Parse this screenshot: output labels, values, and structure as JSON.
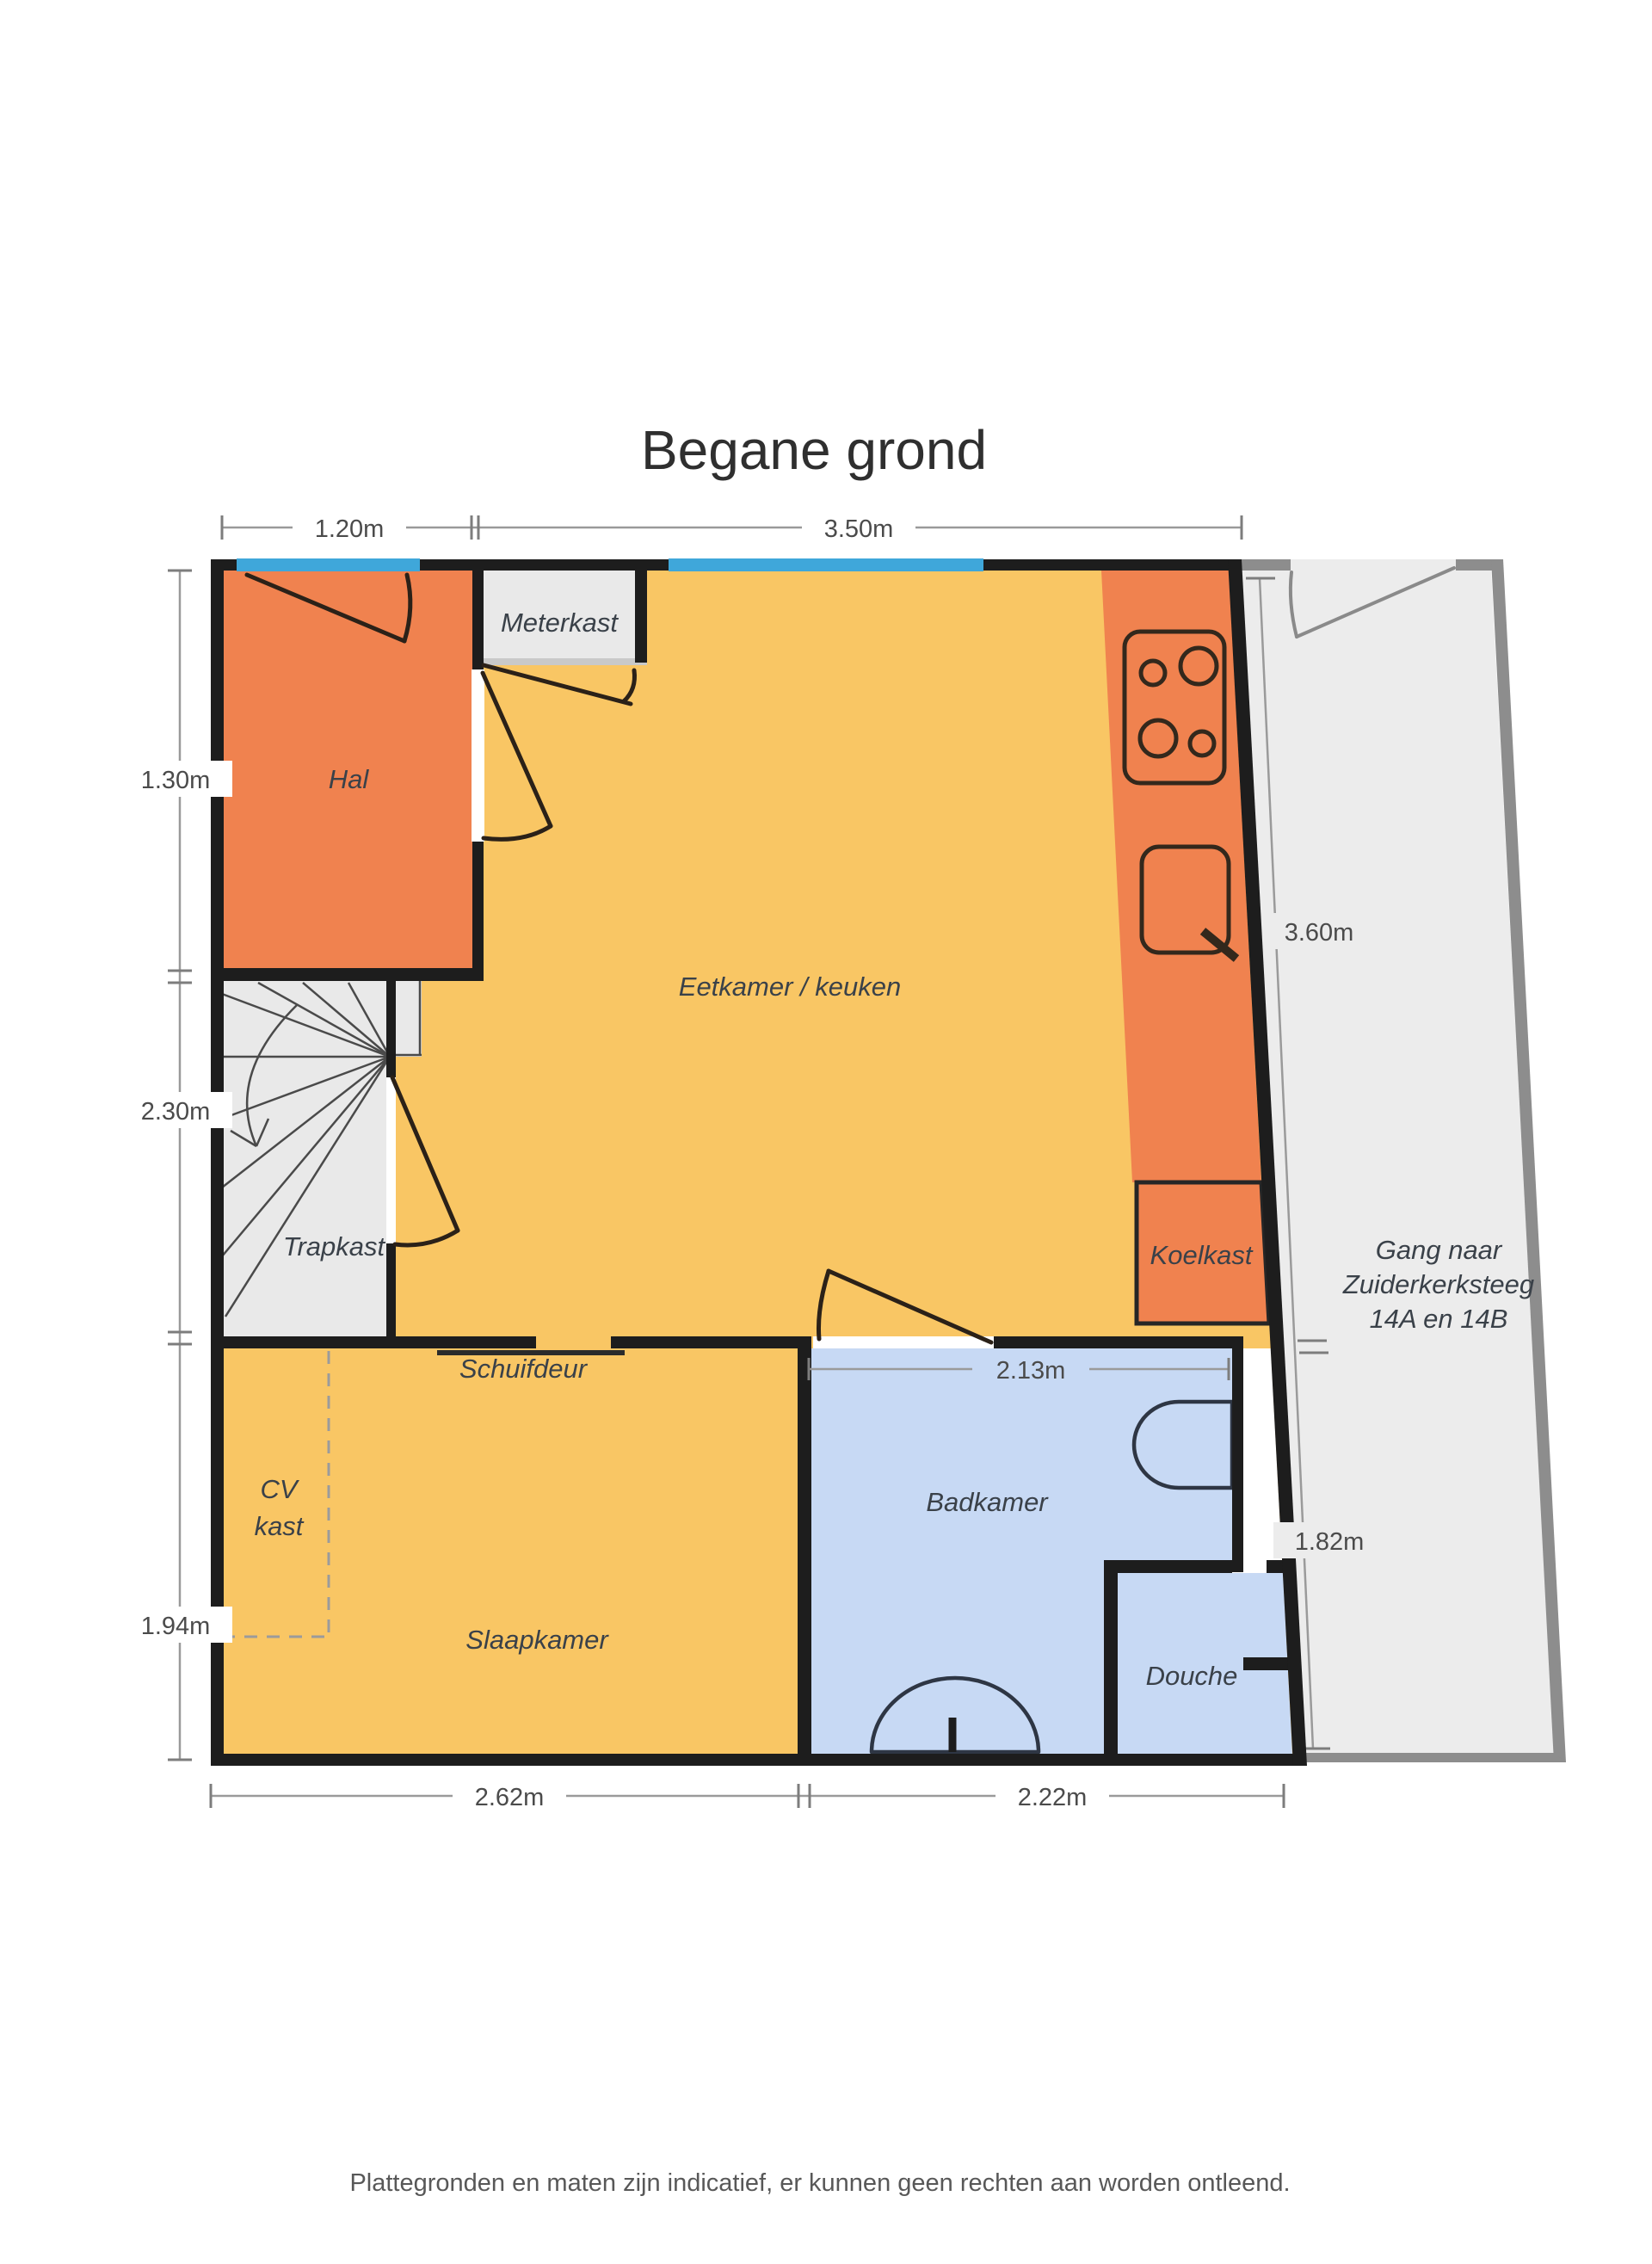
{
  "title": "Begane grond",
  "footer": "Plattegronden en maten zijn indicatief, er kunnen geen rechten aan worden ontleend.",
  "rooms": {
    "hal": "Hal",
    "meterkast": "Meterkast",
    "eetkamer": "Eetkamer / keuken",
    "trapkast": "Trapkast",
    "koelkast": "Koelkast",
    "schuifdeur": "Schuifdeur",
    "cv_line1": "CV",
    "cv_line2": "kast",
    "slaapkamer": "Slaapkamer",
    "badkamer": "Badkamer",
    "douche": "Douche",
    "gang_line1": "Gang naar",
    "gang_line2": "Zuiderkerksteeg",
    "gang_line3": "14A en 14B"
  },
  "dimensions": {
    "top_left": "1.20m",
    "top_right": "3.50m",
    "left_upper": "1.30m",
    "left_middle": "2.30m",
    "left_lower": "1.94m",
    "right_upper": "3.60m",
    "right_lower": "1.82m",
    "badkamer_width": "2.13m",
    "bottom_left": "2.62m",
    "bottom_right": "2.22m"
  },
  "colors": {
    "floor_yellow": "#f9c664",
    "accent_orange": "#f0824f",
    "bathroom_blue": "#c7d9f4",
    "window_blue": "#3fa7da",
    "closet_gray": "#e9e9e9",
    "corridor_gray": "#ececec",
    "corridor_wall_gray": "#8d8d8d",
    "wall_black": "#1d1d1d"
  }
}
